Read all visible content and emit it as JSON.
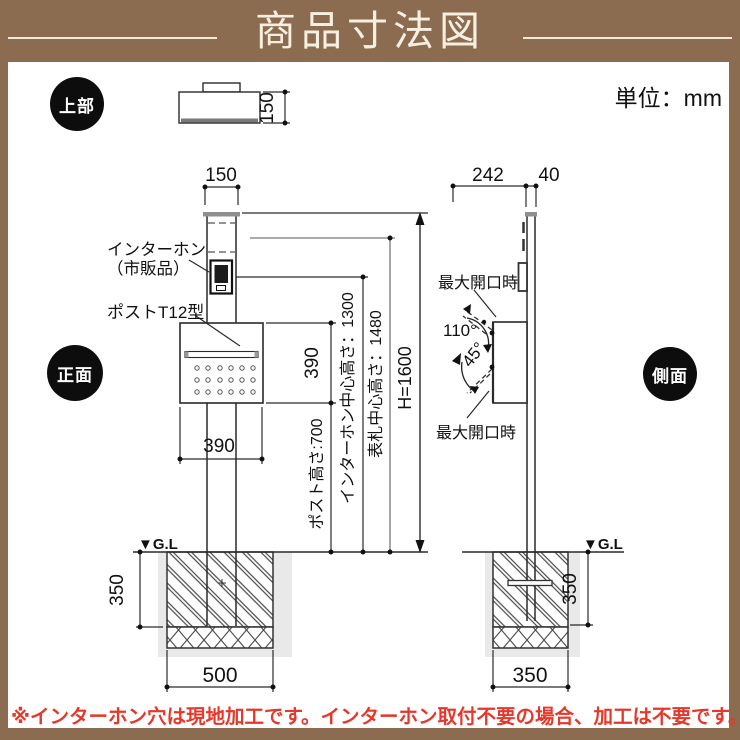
{
  "header": {
    "title": "商品寸法図"
  },
  "unit_label": "単位：mm",
  "badges": {
    "top": "上部",
    "front": "正面",
    "side": "側面"
  },
  "annotations": {
    "intercom_line1": "インターホン",
    "intercom_line2": "（市販品）",
    "post_model": "ポストT12型",
    "ground_level_front": "▼G.L",
    "ground_level_side": "▼G.L",
    "max_open_top": "最大開口時",
    "max_open_bottom": "最大開口時"
  },
  "dims": {
    "top_view_depth": "150",
    "post_width": "150",
    "mailbox_width": "390",
    "mailbox_height": "390",
    "post_height": "ポスト高さ:700",
    "intercom_center_height": "インターホン中心高さ：1300",
    "nameplate_center_height": "表札中心高さ：1480",
    "total_height": "H=1600",
    "side_depth_mailbox": "242",
    "side_depth_post": "40",
    "open_angle_top": "110°",
    "open_angle_bottom": "45°",
    "foundation_depth_front": "350",
    "foundation_width_front": "500",
    "foundation_depth_side": "350",
    "foundation_width_side": "350"
  },
  "note": "※インターホン穴は現地加工です。インターホン取付不要の場合、加工は不要です。",
  "colors": {
    "frame_brown": "#8b6c50",
    "note_red": "#e8372a",
    "badge_black": "#0d0d0d",
    "dim_gray": "#8f8f8f"
  }
}
